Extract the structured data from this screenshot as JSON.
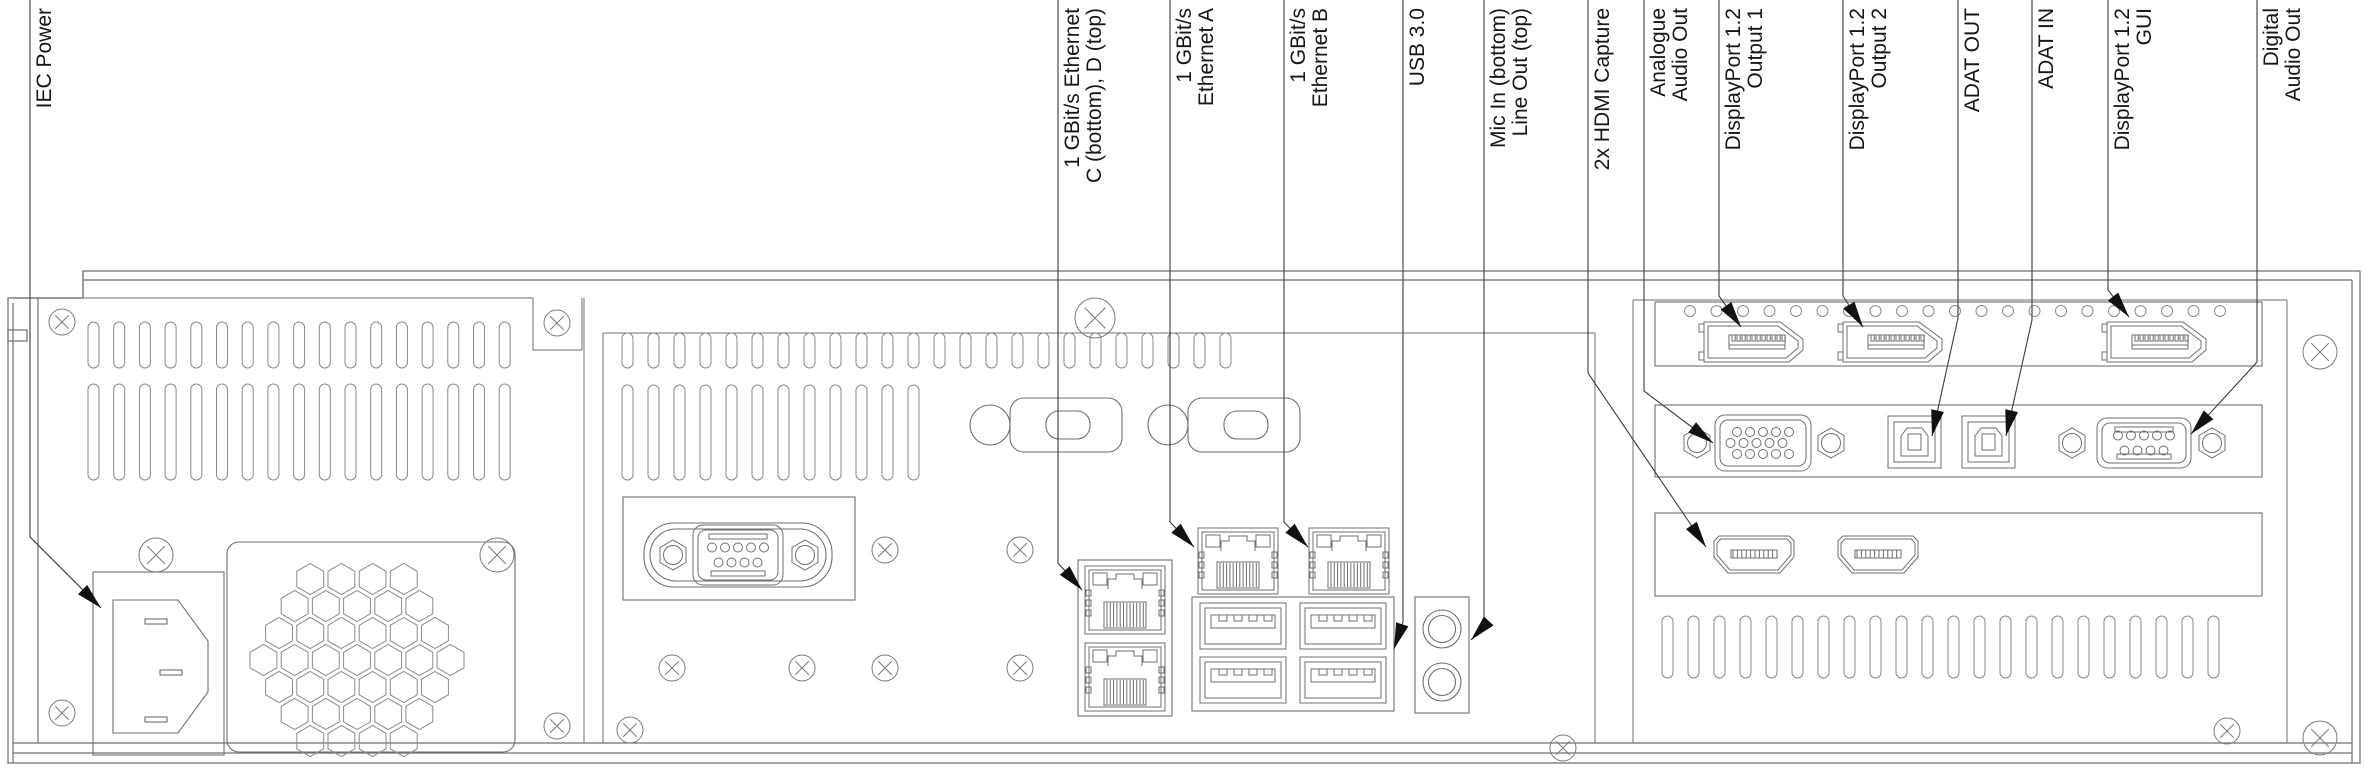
{
  "colors": {
    "background": "#ffffff",
    "chassis_line": "#6f6f6f",
    "detail_line": "#8a8a8a",
    "leader_line": "#3a3a3a",
    "arrow_fill": "#111111",
    "label_text": "#161616"
  },
  "labels": [
    {
      "id": "iec-power",
      "lines": [
        "IEC Power"
      ]
    },
    {
      "id": "ethernet-c-d",
      "lines": [
        "1 GBit/s Ethernet",
        "C (bottom), D (top)"
      ]
    },
    {
      "id": "ethernet-a",
      "lines": [
        "1 GBit/s",
        "Ethernet A"
      ]
    },
    {
      "id": "ethernet-b",
      "lines": [
        "1 GBit/s",
        "Ethernet B"
      ]
    },
    {
      "id": "usb-3-0",
      "lines": [
        "USB 3.0"
      ]
    },
    {
      "id": "mic-in-line-out",
      "lines": [
        "Mic In (bottom)",
        "Line Out (top)"
      ]
    },
    {
      "id": "hdmi-capture",
      "lines": [
        "2x HDMI Capture"
      ]
    },
    {
      "id": "analogue-audio-out",
      "lines": [
        "Analogue",
        "Audio Out"
      ]
    },
    {
      "id": "displayport-output-1",
      "lines": [
        "DisplayPort 1.2",
        "Output 1"
      ]
    },
    {
      "id": "displayport-output-2",
      "lines": [
        "DisplayPort 1.2",
        "Output 2"
      ]
    },
    {
      "id": "adat-out",
      "lines": [
        "ADAT OUT"
      ]
    },
    {
      "id": "adat-in",
      "lines": [
        "ADAT IN"
      ]
    },
    {
      "id": "displayport-gui",
      "lines": [
        "DisplayPort 1.2",
        "GUI"
      ]
    },
    {
      "id": "digital-audio-out",
      "lines": [
        "Digital",
        "Audio Out"
      ]
    }
  ],
  "connectors": [
    "iec-c14-inlet",
    "fan-grille",
    "serial-db9",
    "vga-blank-cutout-1",
    "vga-blank-cutout-2",
    "ethernet-d-rj45",
    "ethernet-c-rj45",
    "ethernet-a-rj45",
    "ethernet-b-rj45",
    "usb3-port-1",
    "usb3-port-2",
    "usb3-port-3",
    "usb3-port-4",
    "line-out-jack",
    "mic-in-jack",
    "displayport-output-1",
    "displayport-output-2",
    "displayport-gui",
    "analogue-audio-de15",
    "adat-out-toslink",
    "adat-in-toslink",
    "digital-audio-db9",
    "hdmi-capture-1",
    "hdmi-capture-2"
  ]
}
